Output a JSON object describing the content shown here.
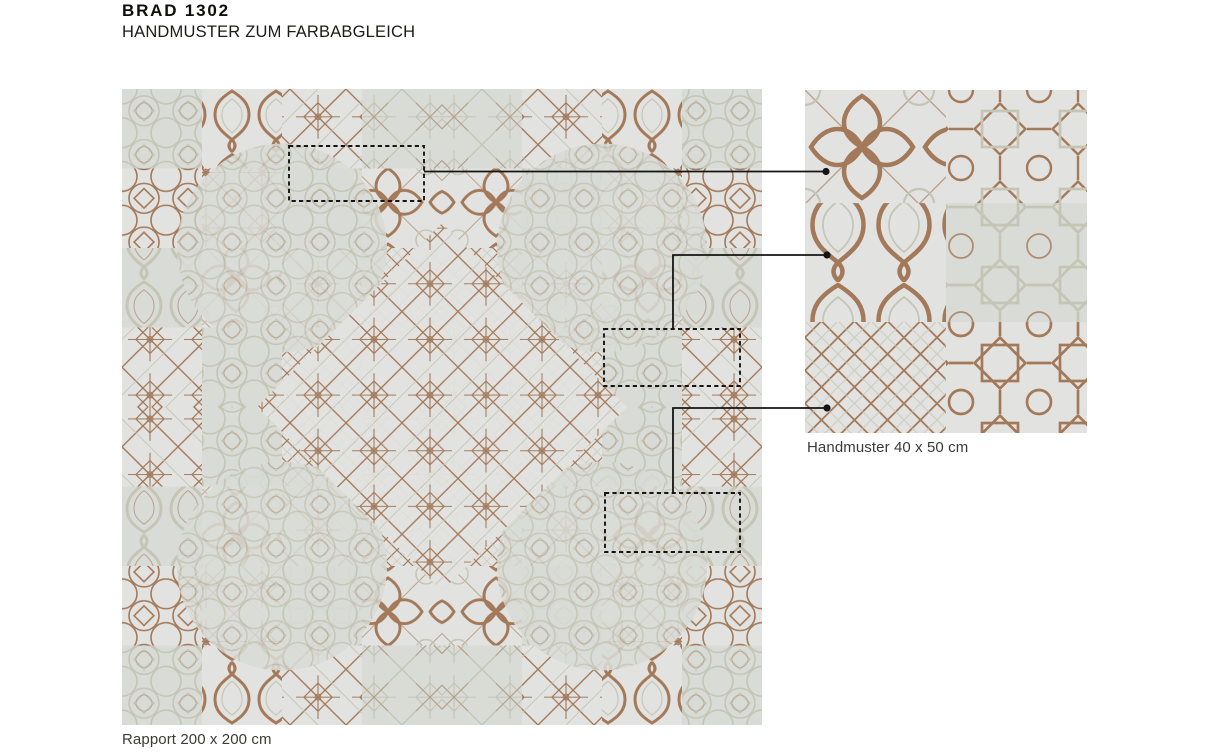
{
  "page": {
    "title": "BRAD 1302",
    "subtitle": "HANDMUSTER ZUM FARBABGLEICH"
  },
  "rapport": {
    "caption": "Rapport 200 x 200 cm"
  },
  "handmuster": {
    "caption": "Handmuster 40 x 50 cm"
  },
  "colors": {
    "brown": "#a3795a",
    "brown_dark": "#8d684c",
    "sage": "#c5c5b6",
    "cloth_bg": "#e2e3e0",
    "cloth_bg_alt": "#d9dbd6",
    "ink": "#151513",
    "caption_text": "#3a3a38",
    "paper": "#ffffff",
    "connector": "#141414"
  }
}
